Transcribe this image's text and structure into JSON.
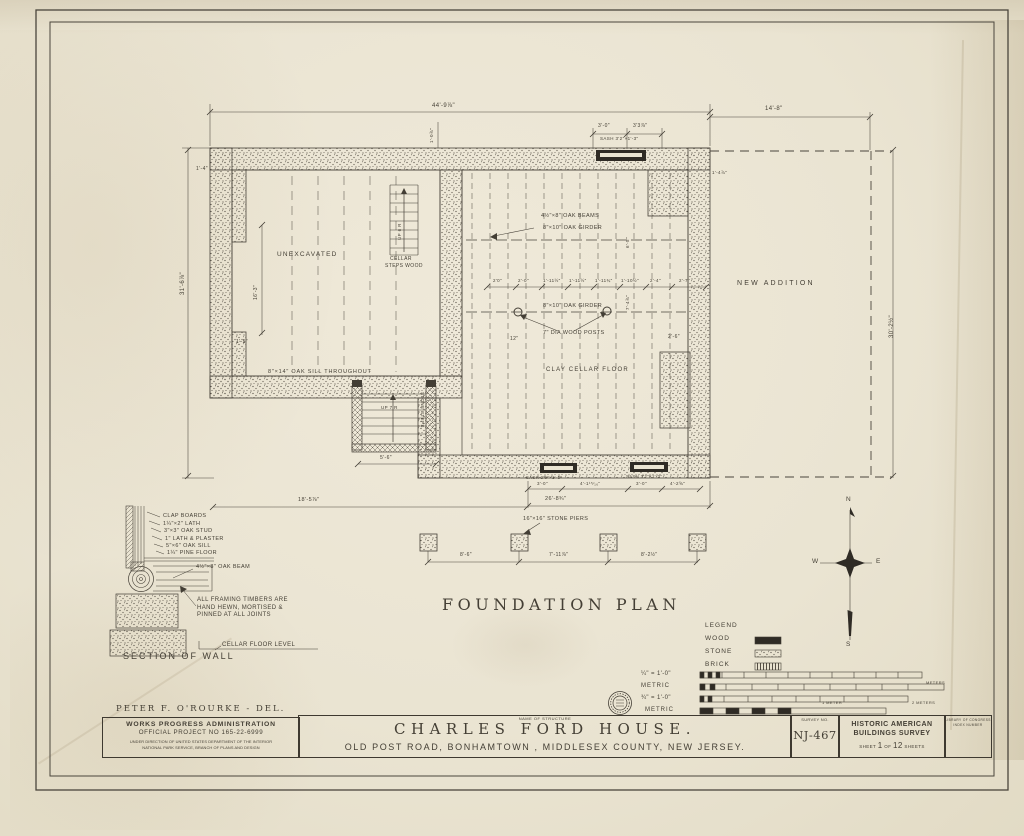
{
  "sheet": {
    "plan_title": "FOUNDATION PLAN",
    "section_title": "SECTION OF WALL"
  },
  "plan": {
    "rooms": {
      "unexcavated": "UNEXCAVATED",
      "new_addition": "NEW ADDITION",
      "clay_floor": "CLAY CELLAR FLOOR"
    },
    "labels": {
      "oak_beams": "4½\"×8\" OAK BEAMS",
      "girder_top": "8\"×10\" OAK GIRDER",
      "girder_mid": "8\"×10\" OAK GIRDER",
      "wood_posts": "7\" DIA WOOD POSTS",
      "oak_sill": "8\"×14\" OAK SILL THROUGHOUT",
      "cellar_steps_1": "CELLAR",
      "cellar_steps_2": "STEPS WOOD",
      "up_6r": "UP 6 R",
      "up_7r": "UP 7 R",
      "stone_steps": "STONE STEPS",
      "stone_piers": "16\"×16\" STONE PIERS",
      "sash_top": "SASH 3'2\"×1'-3\"",
      "sash_bottom_left": "SASH 2'6\"×1'-3\"",
      "sash_bottom_right": "SASH 3'2\"×1'-3\""
    },
    "dims": {
      "top_width": "44'-9⅞\"",
      "addition_width": "14'-8\"",
      "addition_height": "30'-2½\"",
      "left_height": "31'-6⅞\"",
      "win_a": "3'-0\"",
      "win_b": "3'3⅞\"",
      "wall_offset": "1'-4\"",
      "right_offset": "1'-4⅞\"",
      "stair_rise": "1'-0⅞\"",
      "interior_height": "16'-3\"",
      "small_left": "1'-5\"",
      "post_offset": "12\"",
      "chimney": "2'-6\"",
      "girder_a": "6'-5\"",
      "girder_b": "7'-4⅞\"",
      "steps_width": "5'-6\"",
      "left_bottom": "18'-5⅞\"",
      "cellar_width": "26'-8¾\"",
      "mid": [
        "2'0\"",
        "2'-0\"",
        "1'-11½\"",
        "1'-11½\"",
        "1'-11¾\"",
        "1'-10½\"",
        "2'-4\"",
        "2'-7\""
      ],
      "sash_row": [
        "3'-0\"",
        "4'-1¹⁵⁄₁₆\"",
        "3'-0\"",
        "4'-2⅝\""
      ],
      "piers": [
        "8'-6\"",
        "7'-11⅞\"",
        "8'-2½\""
      ]
    }
  },
  "section": {
    "labels": {
      "clap": "CLAP BOARDS",
      "lath": "1¼\"×2\" LATH",
      "stud": "3\"×3\" OAK STUD",
      "plaster": "1\" LATH & PLASTER",
      "sill": "5\"×6\" OAK SILL",
      "floor": "1¼\" PINE FLOOR",
      "beam": "4½\"×8\" OAK BEAM"
    },
    "note1": "ALL FRAMING TIMBERS ARE",
    "note2": "HAND HEWN, MORTISED &",
    "note3": "PINNED AT ALL JOINTS",
    "level": "CELLAR FLOOR LEVEL"
  },
  "legend": {
    "title": "LEGEND",
    "wood": "WOOD",
    "stone": "STONE",
    "brick": "BRICK"
  },
  "scales": {
    "imperial_quarter": "¼\" = 1'-0\"",
    "metric_1": "METRIC",
    "imperial_three_quarter": "¾\" = 1'-0\"",
    "metric_2": "METRIC",
    "meters": "METERS",
    "one_meter": "1 METER",
    "two_meters": "2 METERS"
  },
  "compass": {
    "n": "N",
    "e": "E",
    "s": "S",
    "w": "W"
  },
  "titleblock": {
    "delineator": "PETER F. O'ROURKE - DEL.",
    "wpa_line1": "WORKS PROGRESS ADMINISTRATION",
    "wpa_line2": "OFFICIAL PROJECT NO 165-22-6999",
    "wpa_line3": "UNDER DIRECTION OF UNITED STATES DEPARTMENT OF THE INTERIOR",
    "wpa_line4": "NATIONAL PARK SERVICE, BRANCH OF PLANS AND DESIGN",
    "name_label": "NAME OF STRUCTURE",
    "structure_name": "CHARLES FORD HOUSE.",
    "address": "OLD POST ROAD, BONHAMTOWN , MIDDLESEX COUNTY, NEW JERSEY.",
    "survey_label": "SURVEY NO.",
    "survey_no": "NJ-467",
    "habs_line1": "HISTORIC AMERICAN",
    "habs_line2": "BUILDINGS SURVEY",
    "sheet_word": "SHEET",
    "sheet_no": "1",
    "of_word": "OF",
    "sheet_total": "12",
    "sheets_word": "SHEETS",
    "loc_line1": "LIBRARY OF CONGRESS",
    "loc_line2": "INDEX NUMBER"
  },
  "colors": {
    "paper": "#eae4d2",
    "ink": "#433e35"
  }
}
